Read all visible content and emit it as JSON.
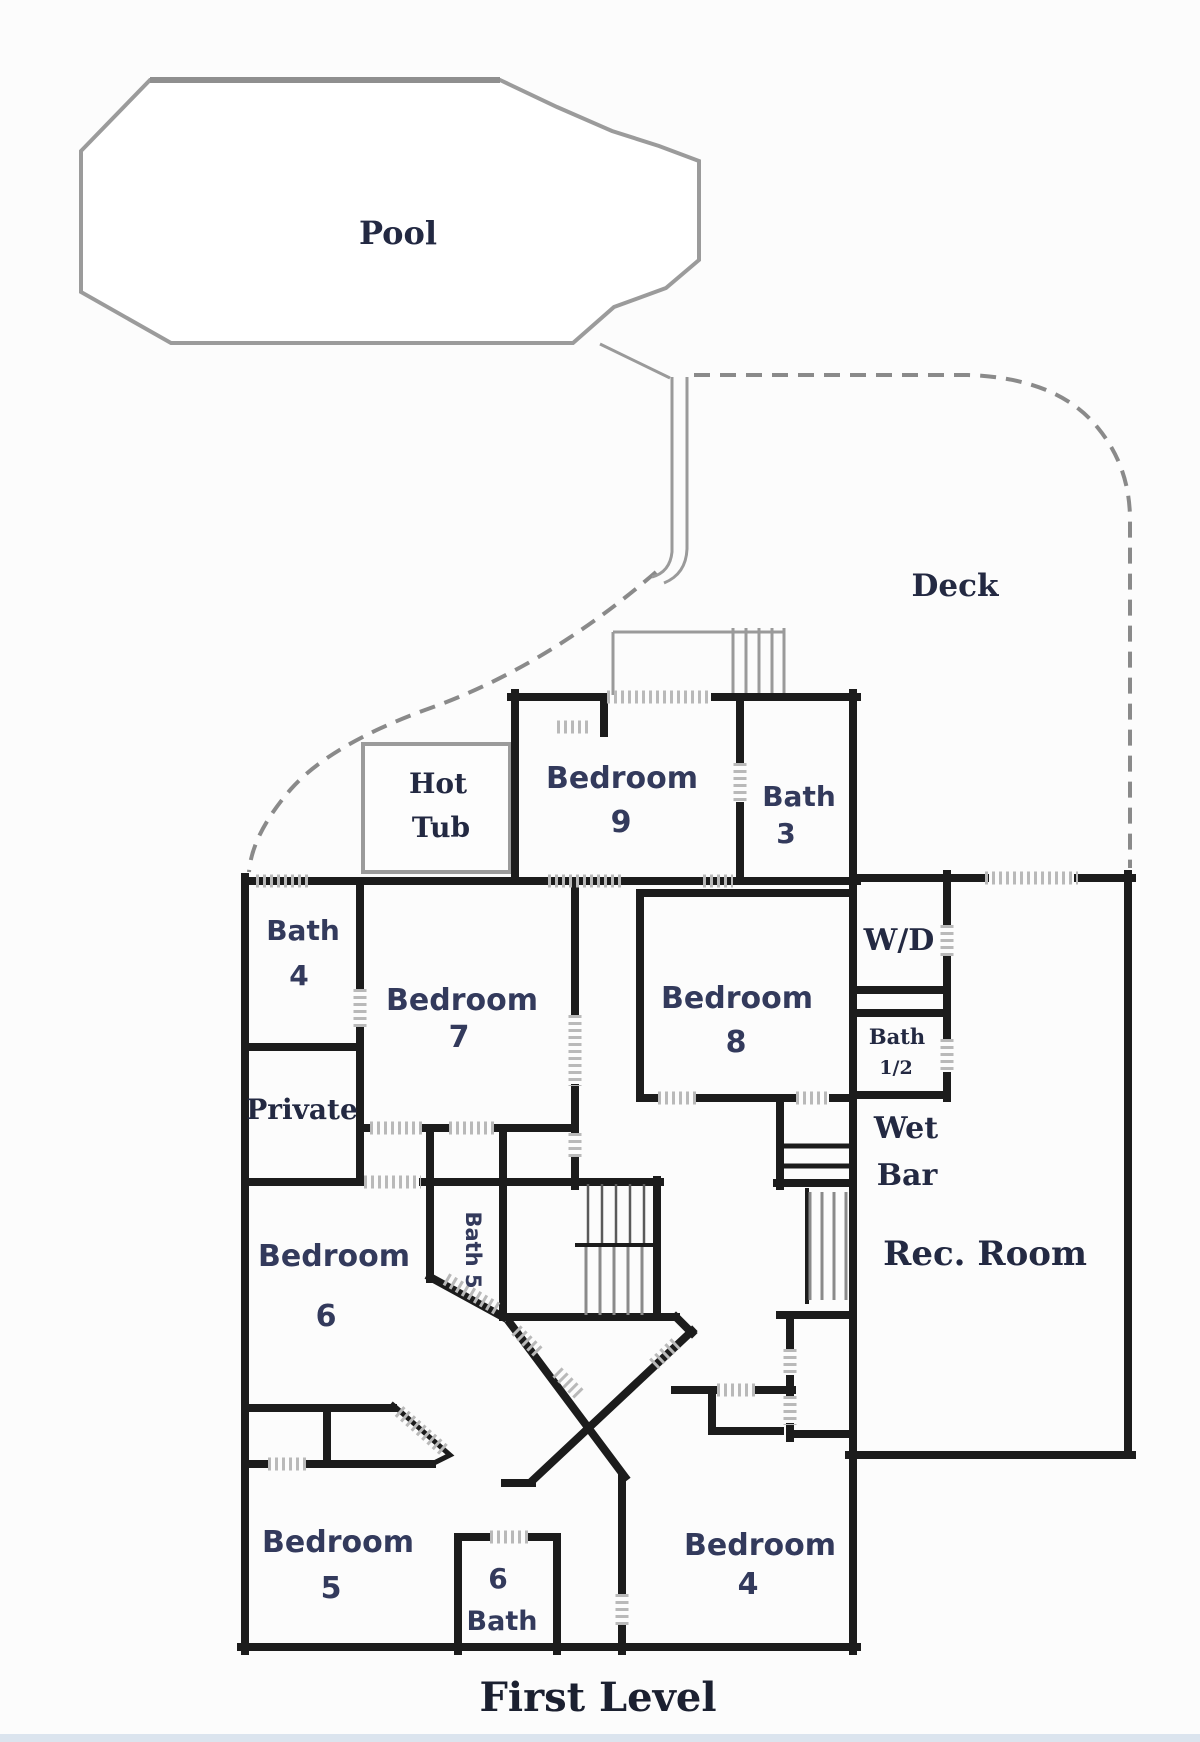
{
  "title": {
    "text": "First Level"
  },
  "outdoor": {
    "pool": "Pool",
    "deck": "Deck",
    "hot_tub": {
      "line1": "Hot",
      "line2": "Tub"
    }
  },
  "rooms": {
    "bedroom9": {
      "name": "Bedroom",
      "number": "9"
    },
    "bath3": {
      "name": "Bath",
      "number": "3"
    },
    "bath4": {
      "name": "Bath",
      "number": "4"
    },
    "bedroom7": {
      "name": "Bedroom",
      "number": "7"
    },
    "bedroom8": {
      "name": "Bedroom",
      "number": "8"
    },
    "wd": {
      "text": "W/D"
    },
    "bath_half": {
      "line1": "Bath",
      "line2": "1/2"
    },
    "private_entry": {
      "text": "Private"
    },
    "wet_bar": {
      "line1": "Wet",
      "line2": "Bar"
    },
    "rec_room": {
      "text": "Rec. Room"
    },
    "bedroom6": {
      "name": "Bedroom",
      "number": "6"
    },
    "bath5": {
      "text": "Bath 5"
    },
    "bedroom5": {
      "name": "Bedroom",
      "number": "5"
    },
    "bath6": {
      "number": "6",
      "name": "Bath"
    },
    "bedroom4": {
      "name": "Bedroom",
      "number": "4"
    }
  },
  "colors": {
    "wall": "#1c1c1c",
    "label_sans": "#333a5c",
    "label_serif": "#232942",
    "gray_outline": "#9a9a9a",
    "hatch": "#b9b9b9",
    "deck_dash": "#8a8a8a",
    "page_bg": "#fbfbfb"
  }
}
